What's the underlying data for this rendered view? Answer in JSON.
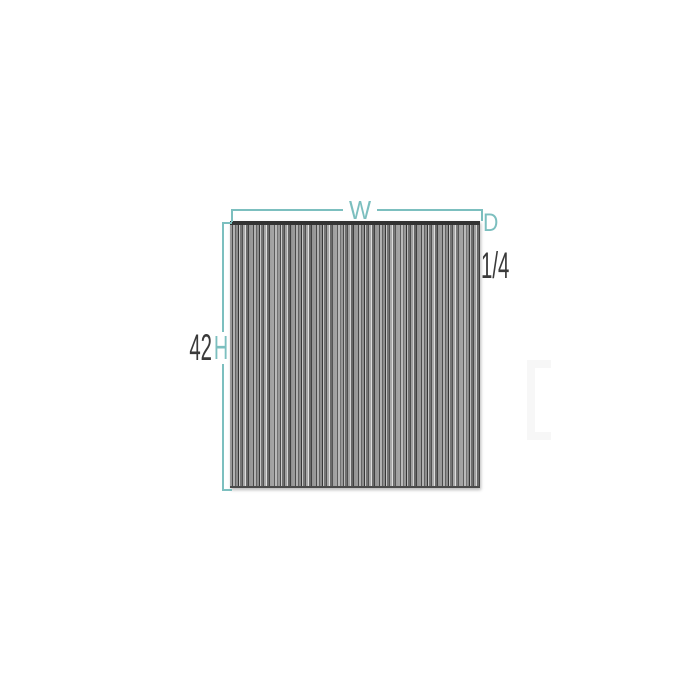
{
  "diagram": {
    "labels": {
      "width": "W",
      "height": "H",
      "height_value": "42",
      "depth": "D",
      "depth_value": "1/4"
    },
    "colors": {
      "dimension_line": "#7CBFBF",
      "value_text": "#3A3A3A",
      "panel_top_edge": "#333333",
      "stripe_dark": "#3C3C3C",
      "stripe_mid": "#8F8F8F",
      "stripe_light": "#C9C9C9"
    }
  }
}
